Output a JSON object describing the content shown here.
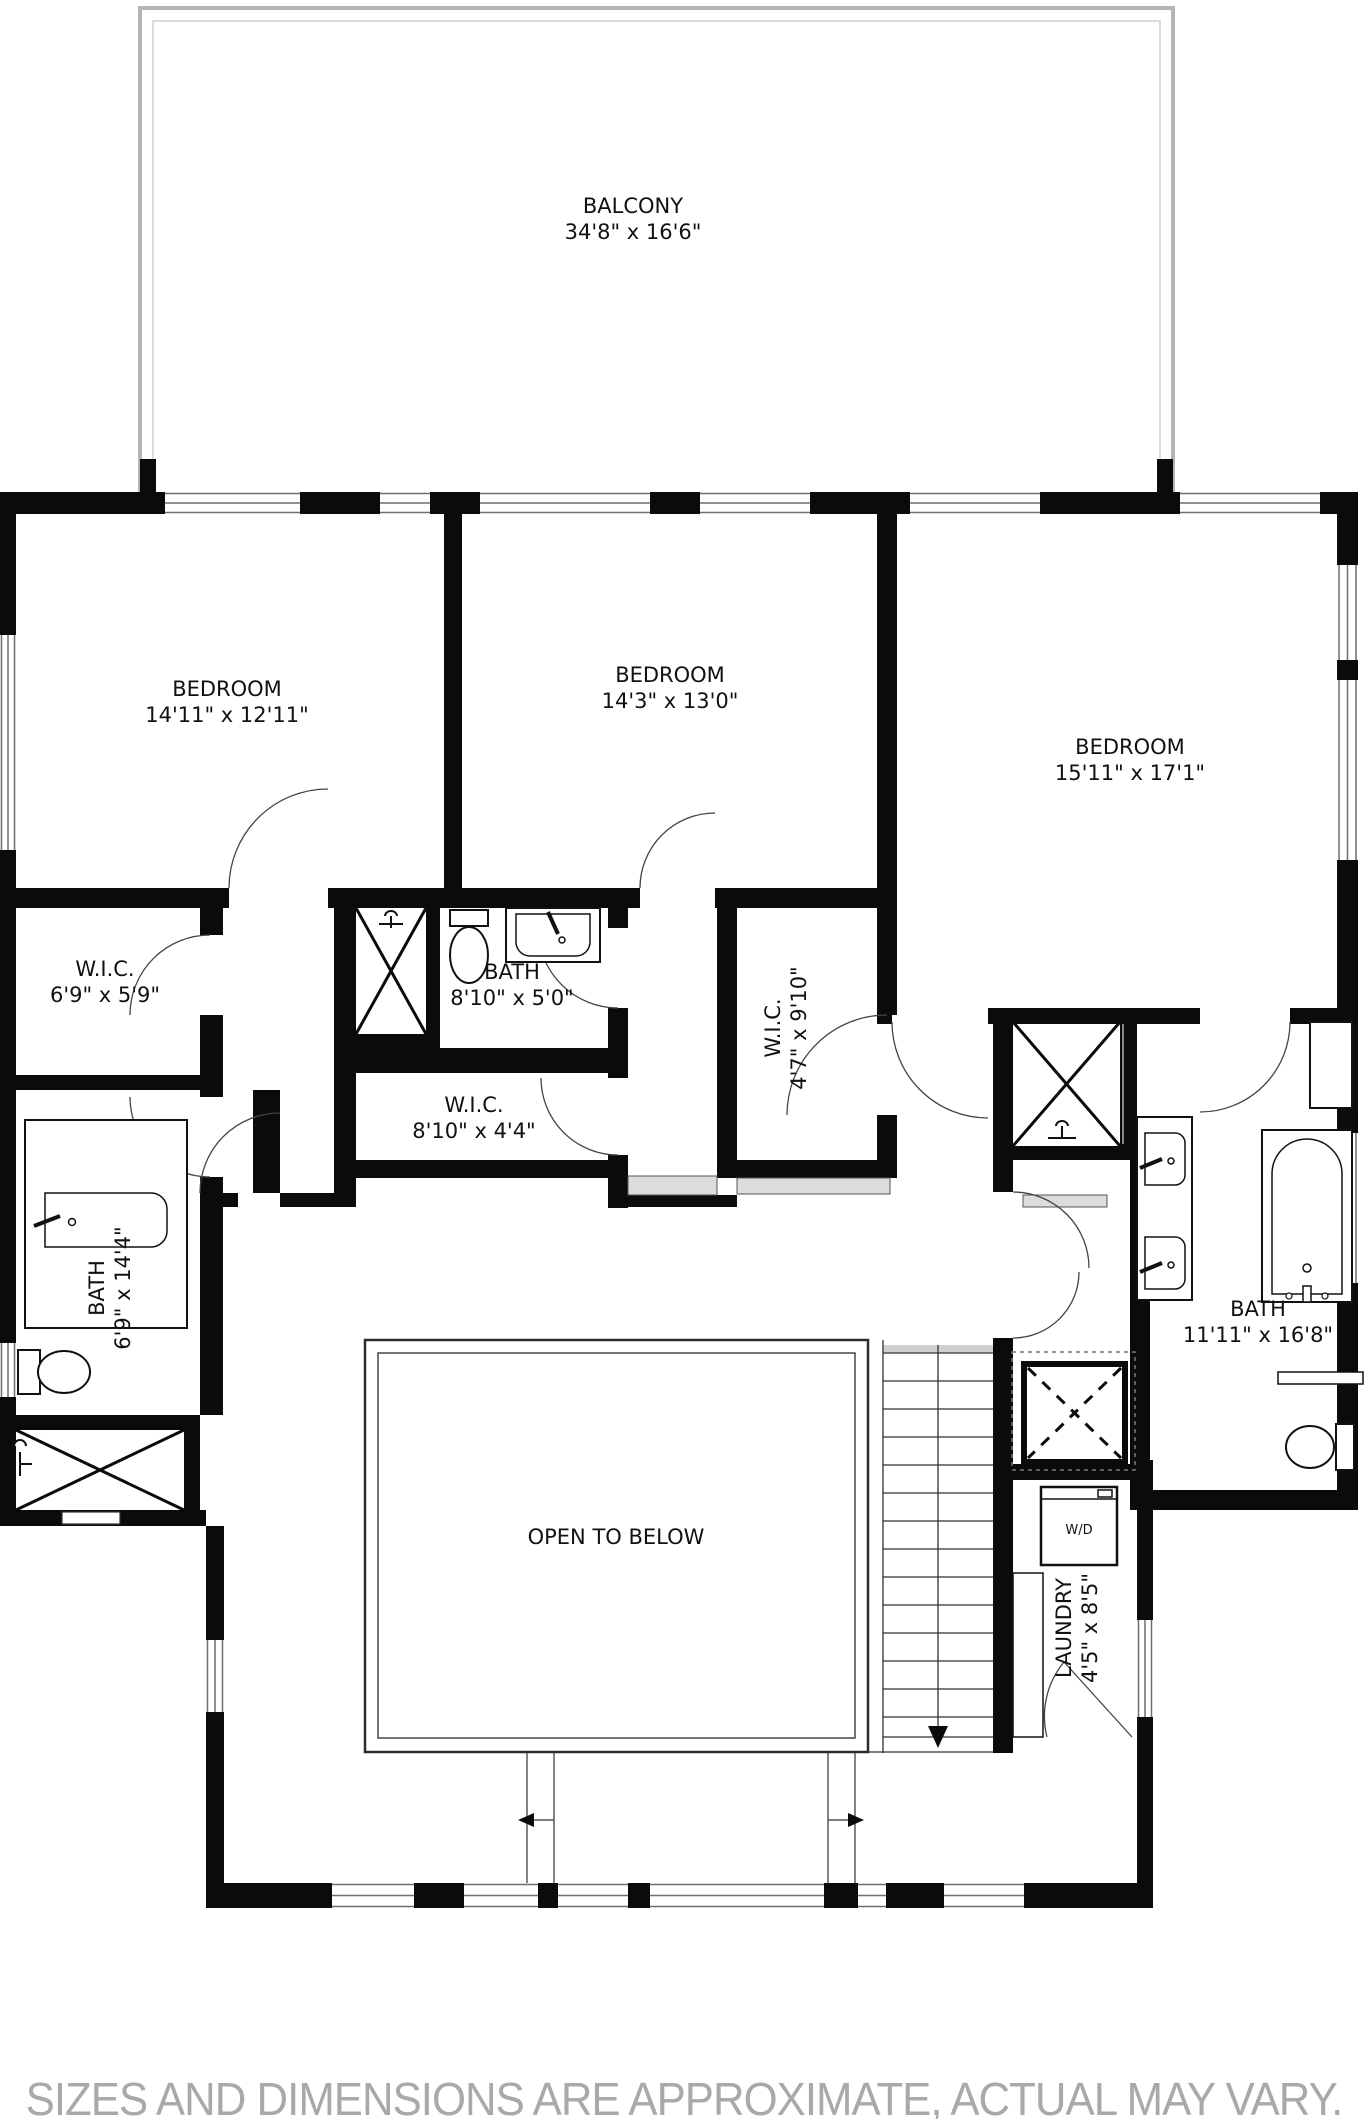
{
  "plan_title": "Upper floor plan",
  "rooms": [
    {
      "id": "balcony",
      "name": "BALCONY",
      "dims": "34'8\" x 16'6\"",
      "x": 633,
      "y": 219,
      "rotate": 0
    },
    {
      "id": "bedroom-left",
      "name": "BEDROOM",
      "dims": "14'11\" x 12'11\"",
      "x": 227,
      "y": 702,
      "rotate": 0
    },
    {
      "id": "bedroom-center",
      "name": "BEDROOM",
      "dims": "14'3\" x 13'0\"",
      "x": 670,
      "y": 688,
      "rotate": 0
    },
    {
      "id": "bedroom-right",
      "name": "BEDROOM",
      "dims": "15'11\" x 17'1\"",
      "x": 1130,
      "y": 760,
      "rotate": 0
    },
    {
      "id": "wic-left",
      "name": "W.I.C.",
      "dims": "6'9\" x 5'9\"",
      "x": 105,
      "y": 982,
      "rotate": 0
    },
    {
      "id": "bath-center",
      "name": "BATH",
      "dims": "8'10\" x 5'0\"",
      "x": 512,
      "y": 985,
      "rotate": 0
    },
    {
      "id": "wic-center",
      "name": "W.I.C.",
      "dims": "8'10\" x 4'4\"",
      "x": 474,
      "y": 1118,
      "rotate": 0
    },
    {
      "id": "wic-vertical",
      "name": "W.I.C.",
      "dims": "4'7\" x 9'10\"",
      "x": 786,
      "y": 1028,
      "rotate": -90
    },
    {
      "id": "bath-left",
      "name": "BATH",
      "dims": "6'9\" x 14'4\"",
      "x": 110,
      "y": 1288,
      "rotate": -90
    },
    {
      "id": "bath-right",
      "name": "BATH",
      "dims": "11'11\" x 16'8\"",
      "x": 1258,
      "y": 1322,
      "rotate": 0
    },
    {
      "id": "open-to-below",
      "name": "OPEN TO BELOW",
      "dims": "",
      "x": 616,
      "y": 1537,
      "rotate": 0
    },
    {
      "id": "laundry",
      "name": "LAUNDRY",
      "dims": "4'5\" x 8'5\"",
      "x": 1077,
      "y": 1628,
      "rotate": -90
    },
    {
      "id": "washer-dryer",
      "name": "W/D",
      "dims": "",
      "x": 1079,
      "y": 1531,
      "rotate": 0,
      "small": true
    }
  ],
  "disclaimer": "SIZES AND DIMENSIONS ARE APPROXIMATE, ACTUAL MAY VARY.",
  "colors": {
    "wall": "#0b0b0b",
    "window_line": "#6e6e6e",
    "balcony_line": "#b4b4b4",
    "opening_fill": "#dcdcdc",
    "disclaimer_text": "#a9a9a9"
  },
  "icons": [
    "toilet-icon",
    "sink-icon",
    "bathtub-icon",
    "shower-icon",
    "washer-dryer-icon",
    "stairs-icon",
    "elevator-icon",
    "door-arc-icon",
    "window-icon",
    "down-arrow-icon"
  ]
}
